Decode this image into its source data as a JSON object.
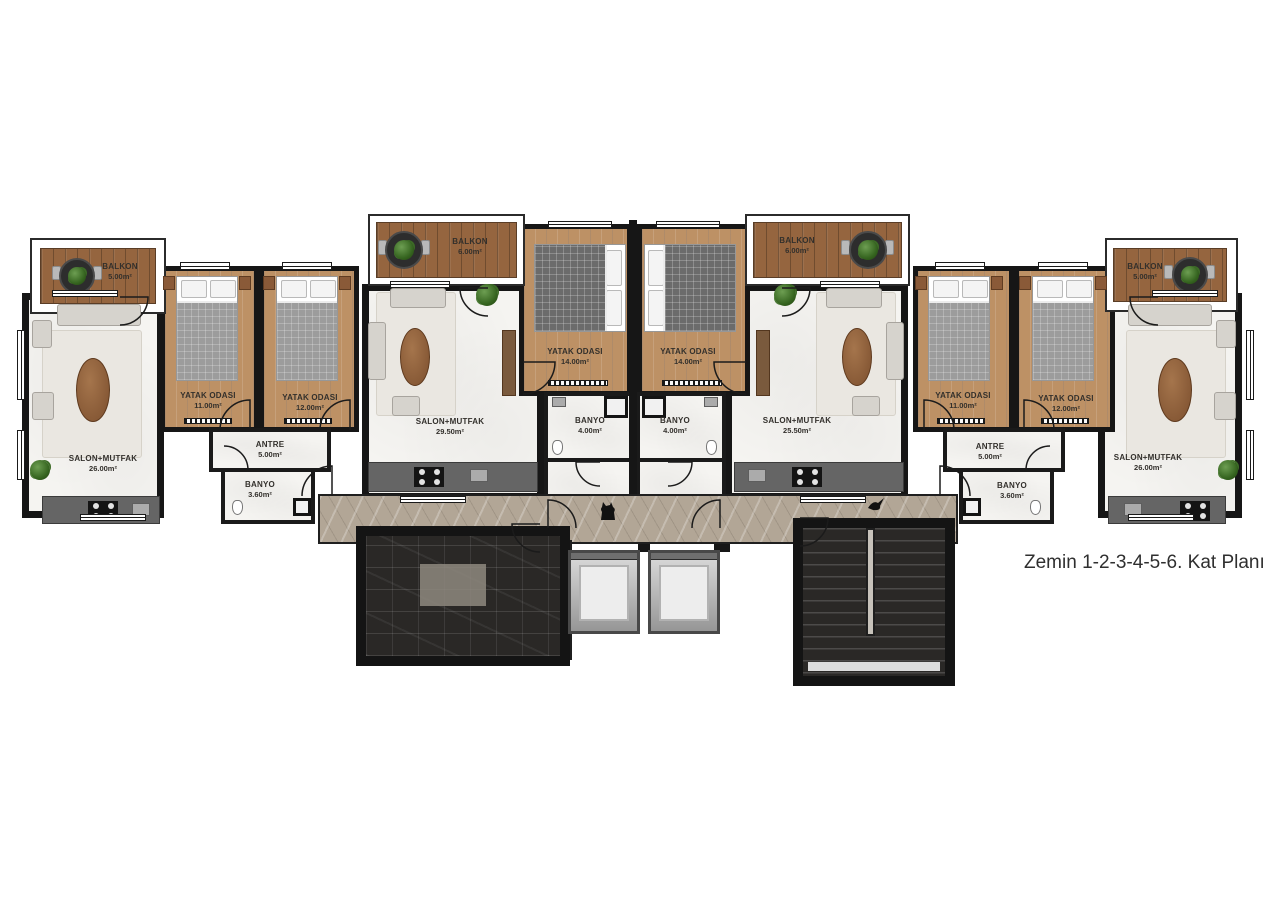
{
  "caption": "Zemin 1-2-3-4-5-6. Kat Planı",
  "units": {
    "far_left": {
      "balkon": {
        "name": "BALKON",
        "area": "5.00m²"
      },
      "salon": {
        "name": "SALON+MUTFAK",
        "area": "26.00m²"
      },
      "yatak1": {
        "name": "YATAK ODASI",
        "area": "11.00m²"
      },
      "yatak2": {
        "name": "YATAK ODASI",
        "area": "12.00m²"
      },
      "antre": {
        "name": "ANTRE",
        "area": "5.00m²"
      },
      "banyo": {
        "name": "BANYO",
        "area": "3.60m²"
      }
    },
    "center_left": {
      "balkon": {
        "name": "BALKON",
        "area": "6.00m²"
      },
      "salon": {
        "name": "SALON+MUTFAK",
        "area": "29.50m²"
      },
      "yatak": {
        "name": "YATAK ODASI",
        "area": "14.00m²"
      },
      "banyo": {
        "name": "BANYO",
        "area": "4.00m²"
      }
    },
    "center_right": {
      "balkon": {
        "name": "BALKON",
        "area": "6.00m²"
      },
      "salon": {
        "name": "SALON+MUTFAK",
        "area": "25.50m²"
      },
      "yatak": {
        "name": "YATAK ODASI",
        "area": "14.00m²"
      },
      "banyo": {
        "name": "BANYO",
        "area": "4.00m²"
      }
    },
    "far_right": {
      "balkon": {
        "name": "BALKON",
        "area": "5.00m²"
      },
      "salon": {
        "name": "SALON+MUTFAK",
        "area": "26.00m²"
      },
      "yatak1": {
        "name": "YATAK ODASI",
        "area": "11.00m²"
      },
      "yatak2": {
        "name": "YATAK ODASI",
        "area": "12.00m²"
      },
      "antre": {
        "name": "ANTRE",
        "area": "5.00m²"
      },
      "banyo": {
        "name": "BANYO",
        "area": "3.60m²"
      }
    }
  },
  "colors": {
    "wall": "#161616",
    "balcony_wood": "#95653f",
    "bedroom_wood": "#bd9165",
    "light_floor": "#f5f4f1",
    "dark_marble": "#2a2826",
    "beige_marble": "#b2a696",
    "plant_green": "#4a7c39"
  },
  "decor_icons": {
    "plant": "potted-plant-icon",
    "round_table": "balcony-table-icon",
    "cat": "cat-silhouette-icon",
    "bird": "bird-silhouette-icon"
  }
}
